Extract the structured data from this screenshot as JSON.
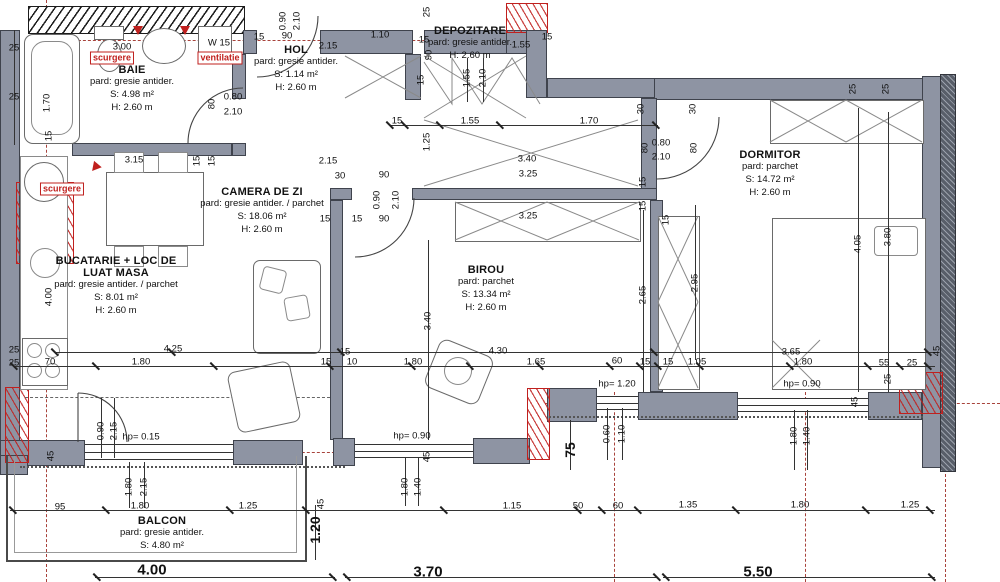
{
  "colors": {
    "wall": "#8e94a3",
    "wall_edge": "#3f434d",
    "red": "#c0201e",
    "axis_red": "#a8433c",
    "line": "#333333"
  },
  "plan": {
    "rooms": [
      {
        "id": "baie",
        "name": "BAIE",
        "floor": "pard: gresie antider.",
        "area": "S: 4.98 m²",
        "height": "H: 2.60 m"
      },
      {
        "id": "hol",
        "name": "HOL",
        "floor": "pard: gresie antider.",
        "area": "S: 1.14 m²",
        "height": "H: 2.60 m"
      },
      {
        "id": "depozitare",
        "name": "DEPOZITARE",
        "floor": "pard: gresie antider.",
        "area": "",
        "height": "H: 2.60 m"
      },
      {
        "id": "camera-de-zi",
        "name": "CAMERA DE ZI",
        "floor": "pard: gresie antider. / parchet",
        "area": "S: 18.06 m²",
        "height": "H: 2.60 m"
      },
      {
        "id": "bucatarie",
        "name": "BUCATARIE + LOC DE LUAT MASA",
        "floor": "pard: gresie antider. / parchet",
        "area": "S: 8.01 m²",
        "height": "H: 2.60 m"
      },
      {
        "id": "birou",
        "name": "BIROU",
        "floor": "pard: parchet",
        "area": "S: 13.34 m²",
        "height": "H: 2.60 m"
      },
      {
        "id": "dormitor",
        "name": "DORMITOR",
        "floor": "pard: parchet",
        "area": "S: 14.72 m²",
        "height": "H: 2.60 m"
      },
      {
        "id": "balcon",
        "name": "BALCON",
        "floor": "pard: gresie antider.",
        "area": "S: 4.80 m²",
        "height": ""
      }
    ],
    "annotations": [
      "scurgere",
      "ventilatie",
      "scurgere"
    ],
    "totals": [
      "4.00",
      "3.70",
      "5.50"
    ],
    "dimensions": [
      {
        "t": "0.90",
        "x": 283,
        "y": 21,
        "v": 1
      },
      {
        "t": "2.10",
        "x": 297,
        "y": 21,
        "v": 1
      },
      {
        "t": "3.00",
        "x": 122,
        "y": 47
      },
      {
        "t": "15",
        "x": 259,
        "y": 37
      },
      {
        "t": "90",
        "x": 287,
        "y": 36
      },
      {
        "t": "1.10",
        "x": 380,
        "y": 35
      },
      {
        "t": "2.15",
        "x": 328,
        "y": 46
      },
      {
        "t": "15",
        "x": 424,
        "y": 40
      },
      {
        "t": "90",
        "x": 429,
        "y": 55,
        "v": 1
      },
      {
        "t": "1.55",
        "x": 521,
        "y": 45
      },
      {
        "t": "25",
        "x": 427,
        "y": 12,
        "v": 1
      },
      {
        "t": "15",
        "x": 547,
        "y": 37
      },
      {
        "t": "25",
        "x": 853,
        "y": 89,
        "v": 1
      },
      {
        "t": "25",
        "x": 886,
        "y": 89,
        "v": 1
      },
      {
        "t": "W 15",
        "x": 219,
        "y": 43
      },
      {
        "t": "25",
        "x": 14,
        "y": 48
      },
      {
        "t": "25",
        "x": 14,
        "y": 97
      },
      {
        "t": "1.70",
        "x": 47,
        "y": 103,
        "v": 1
      },
      {
        "t": "15",
        "x": 49,
        "y": 136,
        "v": 1
      },
      {
        "t": "0.80",
        "x": 233,
        "y": 97
      },
      {
        "t": "2.10",
        "x": 233,
        "y": 112
      },
      {
        "t": "80",
        "x": 212,
        "y": 104,
        "v": 1
      },
      {
        "t": "3.15",
        "x": 134,
        "y": 160
      },
      {
        "t": "15",
        "x": 197,
        "y": 161,
        "v": 1
      },
      {
        "t": "15",
        "x": 212,
        "y": 161,
        "v": 1
      },
      {
        "t": "scurgere",
        "x": 112,
        "y": 58,
        "red": 1
      },
      {
        "t": "ventilatie",
        "x": 220,
        "y": 58,
        "red": 1
      },
      {
        "t": "scurgere",
        "x": 62,
        "y": 189,
        "red": 1
      },
      {
        "t": "15",
        "x": 397,
        "y": 121
      },
      {
        "t": "1.55",
        "x": 470,
        "y": 121
      },
      {
        "t": "1.70",
        "x": 589,
        "y": 121
      },
      {
        "t": "1.25",
        "x": 427,
        "y": 142,
        "v": 1
      },
      {
        "t": "3.40",
        "x": 527,
        "y": 159
      },
      {
        "t": "3.25",
        "x": 528,
        "y": 174
      },
      {
        "t": "1.55",
        "x": 467,
        "y": 78,
        "v": 1
      },
      {
        "t": "2.10",
        "x": 483,
        "y": 78,
        "v": 1
      },
      {
        "t": "15",
        "x": 421,
        "y": 80,
        "v": 1
      },
      {
        "t": "30",
        "x": 641,
        "y": 109,
        "v": 1
      },
      {
        "t": "30",
        "x": 693,
        "y": 109,
        "v": 1
      },
      {
        "t": "80",
        "x": 645,
        "y": 148,
        "v": 1
      },
      {
        "t": "0.80",
        "x": 661,
        "y": 143
      },
      {
        "t": "2.10",
        "x": 661,
        "y": 157
      },
      {
        "t": "80",
        "x": 694,
        "y": 148,
        "v": 1
      },
      {
        "t": "15",
        "x": 643,
        "y": 182,
        "v": 1
      },
      {
        "t": "15",
        "x": 643,
        "y": 206,
        "v": 1
      },
      {
        "t": "30",
        "x": 340,
        "y": 176
      },
      {
        "t": "90",
        "x": 384,
        "y": 175
      },
      {
        "t": "15",
        "x": 325,
        "y": 219
      },
      {
        "t": "15",
        "x": 357,
        "y": 219
      },
      {
        "t": "90",
        "x": 384,
        "y": 219
      },
      {
        "t": "0.90",
        "x": 377,
        "y": 200,
        "v": 1
      },
      {
        "t": "2.10",
        "x": 396,
        "y": 200,
        "v": 1
      },
      {
        "t": "2.15",
        "x": 328,
        "y": 161
      },
      {
        "t": "3.25",
        "x": 528,
        "y": 216
      },
      {
        "t": "15",
        "x": 666,
        "y": 220,
        "v": 1
      },
      {
        "t": "2.65",
        "x": 643,
        "y": 295,
        "v": 1
      },
      {
        "t": "2.95",
        "x": 695,
        "y": 283,
        "v": 1
      },
      {
        "t": "4.05",
        "x": 858,
        "y": 244,
        "v": 1
      },
      {
        "t": "3.80",
        "x": 888,
        "y": 237,
        "v": 1
      },
      {
        "t": "3.40",
        "x": 428,
        "y": 321,
        "v": 1
      },
      {
        "t": "4.00",
        "x": 49,
        "y": 297,
        "v": 1
      },
      {
        "t": "4.25",
        "x": 173,
        "y": 349
      },
      {
        "t": "70",
        "x": 50,
        "y": 362
      },
      {
        "t": "1.80",
        "x": 141,
        "y": 362
      },
      {
        "t": "25",
        "x": 14,
        "y": 350
      },
      {
        "t": "25",
        "x": 14,
        "y": 363
      },
      {
        "t": "15",
        "x": 345,
        "y": 352
      },
      {
        "t": "15",
        "x": 326,
        "y": 362
      },
      {
        "t": "10",
        "x": 352,
        "y": 362
      },
      {
        "t": "1.80",
        "x": 413,
        "y": 362
      },
      {
        "t": "4.30",
        "x": 498,
        "y": 351
      },
      {
        "t": "1.65",
        "x": 536,
        "y": 362
      },
      {
        "t": "60",
        "x": 617,
        "y": 361
      },
      {
        "t": "15",
        "x": 645,
        "y": 362
      },
      {
        "t": "15",
        "x": 668,
        "y": 362
      },
      {
        "t": "1.05",
        "x": 697,
        "y": 362
      },
      {
        "t": "3.65",
        "x": 791,
        "y": 352
      },
      {
        "t": "1.80",
        "x": 803,
        "y": 362
      },
      {
        "t": "55",
        "x": 884,
        "y": 363
      },
      {
        "t": "25",
        "x": 912,
        "y": 363
      },
      {
        "t": "25",
        "x": 888,
        "y": 379,
        "v": 1
      },
      {
        "t": "45",
        "x": 937,
        "y": 351,
        "v": 1
      },
      {
        "t": "45",
        "x": 855,
        "y": 402,
        "v": 1
      },
      {
        "t": "45",
        "x": 427,
        "y": 457,
        "v": 1
      },
      {
        "t": "45",
        "x": 51,
        "y": 456,
        "v": 1
      },
      {
        "t": "45",
        "x": 321,
        "y": 504,
        "v": 1
      },
      {
        "t": "hp= 0.15",
        "x": 141,
        "y": 437
      },
      {
        "t": "hp= 0.90",
        "x": 412,
        "y": 436
      },
      {
        "t": "hp= 1.20",
        "x": 617,
        "y": 384
      },
      {
        "t": "hp= 0.90",
        "x": 802,
        "y": 384
      },
      {
        "t": "0.90",
        "x": 101,
        "y": 431,
        "v": 1
      },
      {
        "t": "2.15",
        "x": 114,
        "y": 431,
        "v": 1
      },
      {
        "t": "1.80",
        "x": 129,
        "y": 487,
        "v": 1
      },
      {
        "t": "2.15",
        "x": 144,
        "y": 487,
        "v": 1
      },
      {
        "t": "1.80",
        "x": 405,
        "y": 487,
        "v": 1
      },
      {
        "t": "1.40",
        "x": 418,
        "y": 487,
        "v": 1
      },
      {
        "t": "0.60",
        "x": 607,
        "y": 434,
        "v": 1
      },
      {
        "t": "1.10",
        "x": 622,
        "y": 434,
        "v": 1
      },
      {
        "t": "1.80",
        "x": 794,
        "y": 436,
        "v": 1
      },
      {
        "t": "1.40",
        "x": 807,
        "y": 436,
        "v": 1
      },
      {
        "t": "95",
        "x": 60,
        "y": 507
      },
      {
        "t": "1.80",
        "x": 140,
        "y": 506
      },
      {
        "t": "1.25",
        "x": 248,
        "y": 506
      },
      {
        "t": "1.15",
        "x": 512,
        "y": 506
      },
      {
        "t": "50",
        "x": 578,
        "y": 506
      },
      {
        "t": "60",
        "x": 618,
        "y": 506
      },
      {
        "t": "1.35",
        "x": 688,
        "y": 505
      },
      {
        "t": "1.80",
        "x": 800,
        "y": 505
      },
      {
        "t": "1.25",
        "x": 910,
        "y": 505
      },
      {
        "t": "1.20",
        "x": 315,
        "y": 530,
        "v": 1,
        "b": 1
      },
      {
        "t": "75",
        "x": 570,
        "y": 450,
        "v": 1,
        "b": 1
      },
      {
        "t": "4.00",
        "x": 152,
        "y": 570,
        "b": 1
      },
      {
        "t": "3.70",
        "x": 428,
        "y": 572,
        "b": 1
      },
      {
        "t": "5.50",
        "x": 758,
        "y": 572,
        "b": 1
      }
    ]
  }
}
